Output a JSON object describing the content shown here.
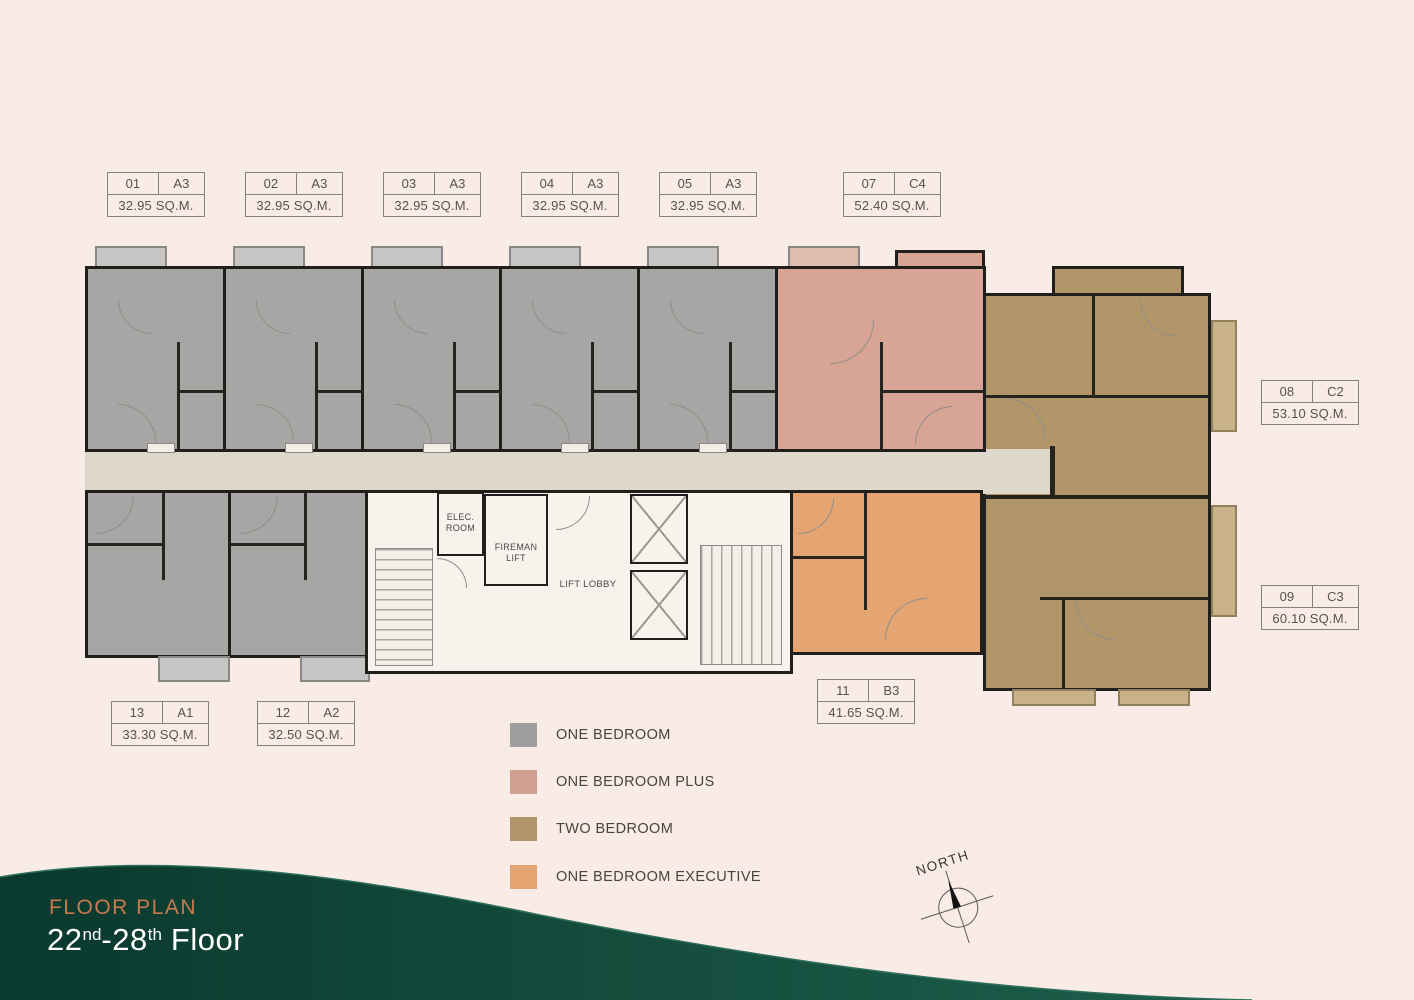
{
  "background": "#f9ebe6",
  "banner": {
    "eyebrow": "FLOOR PLAN",
    "floor_a": "22",
    "floor_a_sup": "nd",
    "floor_b": "-28",
    "floor_b_sup": "th",
    "floor_word": "Floor",
    "eyebrow_color": "#c8794f",
    "wave_gradient": [
      "#0a392d",
      "#1e5f4c"
    ]
  },
  "compass": {
    "label": "NORTH"
  },
  "units": [
    {
      "no": "01",
      "type": "A3",
      "area": "32.95 SQ.M."
    },
    {
      "no": "02",
      "type": "A3",
      "area": "32.95 SQ.M."
    },
    {
      "no": "03",
      "type": "A3",
      "area": "32.95 SQ.M."
    },
    {
      "no": "04",
      "type": "A3",
      "area": "32.95 SQ.M."
    },
    {
      "no": "05",
      "type": "A3",
      "area": "32.95 SQ.M."
    },
    {
      "no": "07",
      "type": "C4",
      "area": "52.40 SQ.M."
    },
    {
      "no": "08",
      "type": "C2",
      "area": "53.10 SQ.M."
    },
    {
      "no": "09",
      "type": "C3",
      "area": "60.10 SQ.M."
    },
    {
      "no": "11",
      "type": "B3",
      "area": "41.65 SQ.M."
    },
    {
      "no": "12",
      "type": "A2",
      "area": "32.50 SQ.M."
    },
    {
      "no": "13",
      "type": "A1",
      "area": "33.30 SQ.M."
    }
  ],
  "legend": {
    "items": [
      {
        "label": "ONE BEDROOM",
        "color": "#a09f9d"
      },
      {
        "label": "ONE BEDROOM PLUS",
        "color": "#cfa092"
      },
      {
        "label": "TWO BEDROOM",
        "color": "#b2966a"
      },
      {
        "label": "ONE BEDROOM EXECUTIVE",
        "color": "#e5a573"
      }
    ]
  },
  "core_rooms": {
    "elec": "ELEC. ROOM",
    "fireman": "FIREMAN LIFT",
    "lift_lobby": "LIFT LOBBY"
  },
  "plan_colors": {
    "one_bedroom": "#a7a6a4",
    "one_bedroom_plus": "#d8a495",
    "two_bedroom": "#b2966a",
    "one_bedroom_executive": "#e5a573",
    "corridor": "#ddd8ca",
    "core": "#f6f2ec",
    "wall": "#211f1c"
  }
}
